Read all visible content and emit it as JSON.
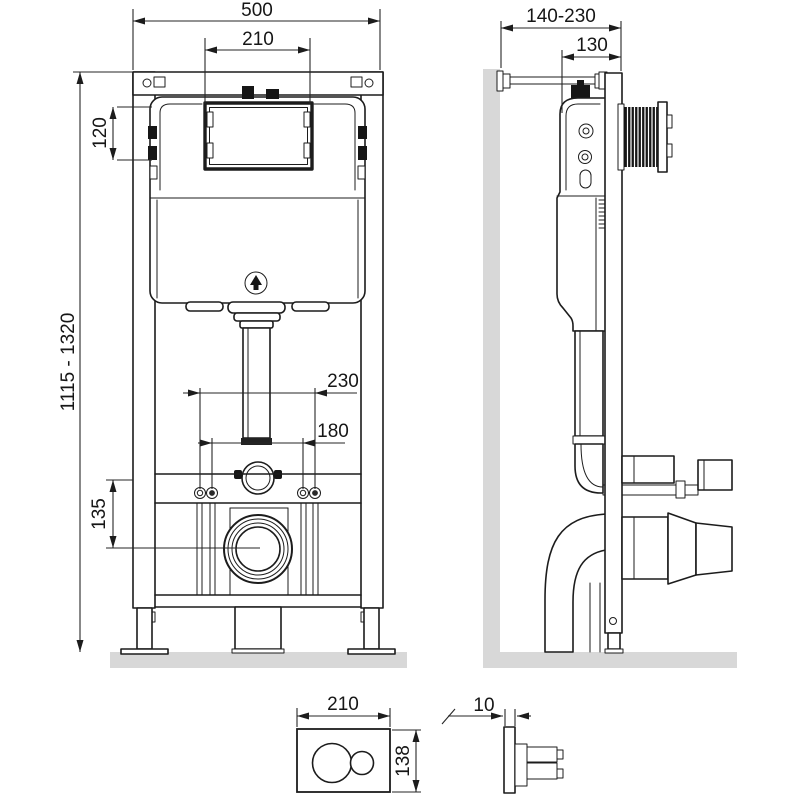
{
  "colors": {
    "line": "#1c1c1c",
    "surface": "#d8d8d8",
    "background": "#ffffff"
  },
  "front_view": {
    "frame_width": "500",
    "service_opening_width": "210",
    "tank_top_offset": "120",
    "installation_height_range": "1115 - 1320",
    "flush_bend_offset": "230",
    "fixing_stud_spacing": "180",
    "waste_outlet_height": "135"
  },
  "side_view": {
    "wall_distance_range": "140-230",
    "frame_depth": "130"
  },
  "flush_plate": {
    "width": "210",
    "height": "138",
    "thickness": "10"
  }
}
